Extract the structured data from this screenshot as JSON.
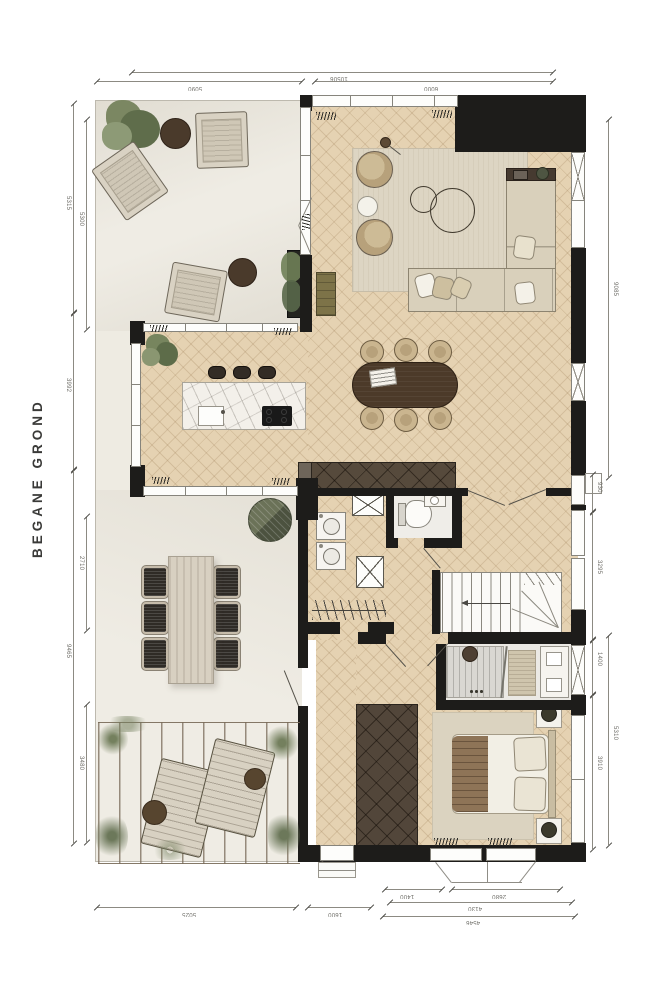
{
  "title": "BEGANE GROND",
  "dims": {
    "top": [
      "10506",
      "5090",
      "6000"
    ],
    "left_outer": [
      "5315",
      "3992",
      "9465"
    ],
    "left_inner": [
      "5300",
      "2710",
      "3480"
    ],
    "right_outer": [
      "9085",
      "5310"
    ],
    "right_inner": [
      "930",
      "3295",
      "1400",
      "3910"
    ],
    "bottom_main": [
      "5025",
      "1600",
      "4546"
    ],
    "bottom_detail": [
      "1400",
      "2680",
      "4130"
    ]
  },
  "palette": {
    "wall": "#1d1c1a",
    "wood_floor": "#e5d2b2",
    "garden_ground": "#eeebe2",
    "marble_island": "#f3f0ea",
    "dark_furniture": "#4c3a29",
    "plant_green": "#74805e",
    "dimension_text": "#6f6e68"
  }
}
